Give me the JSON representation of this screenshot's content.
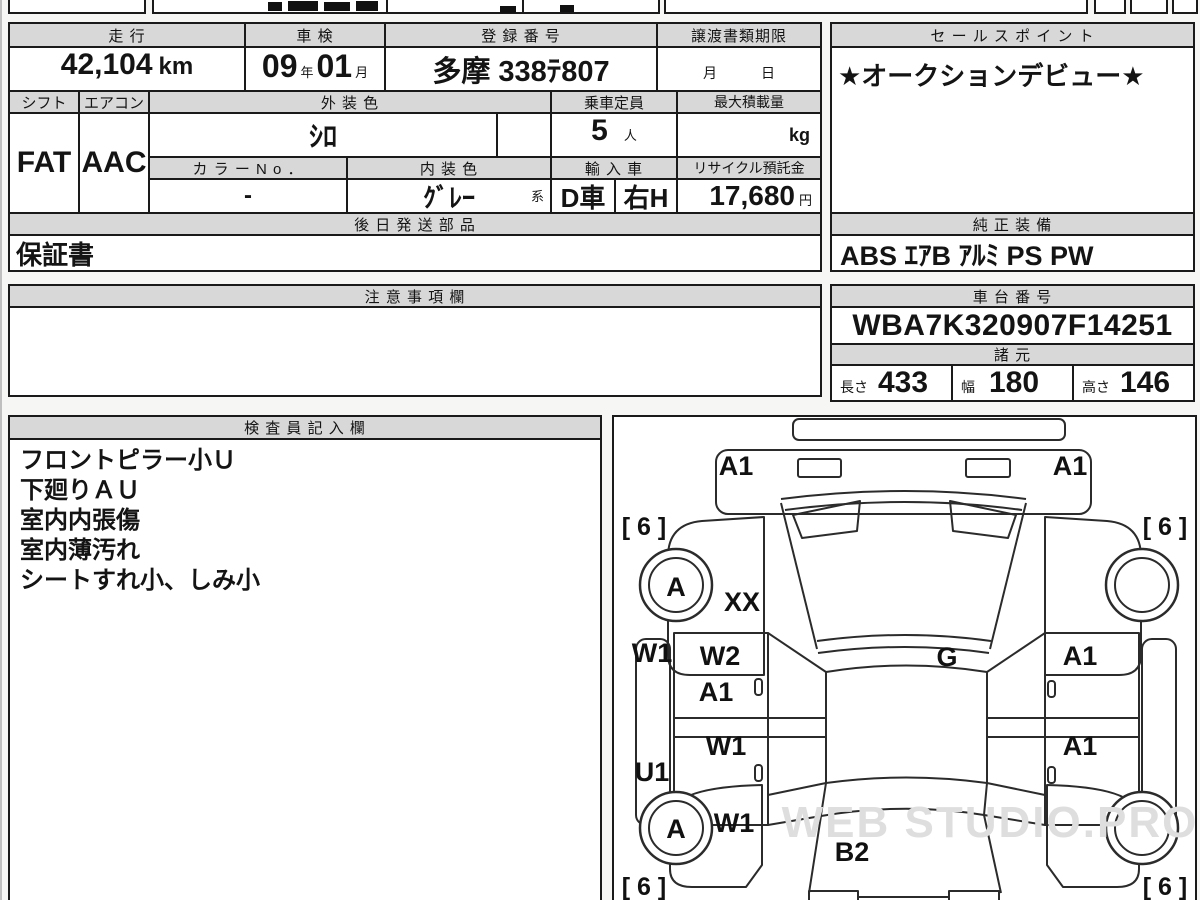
{
  "header_row": {
    "mileage_label": "走 行",
    "inspection_label": "車 検",
    "registration_label": "登 録 番 号",
    "transfer_label": "譲渡書類期限",
    "sales_point_label": "セ ー ル ス ポ イ ン ト"
  },
  "values": {
    "mileage": "42,104",
    "mileage_unit": "km",
    "inspection_year": "09",
    "year_suffix": "年",
    "inspection_month": "01",
    "month_suffix": "月",
    "registration": "多摩 338ﾃ807",
    "transfer_month": "月",
    "transfer_day": "日",
    "sales_point": "★オークションデビュー★"
  },
  "row2": {
    "shift_label": "シフト",
    "aircon_label": "エアコン",
    "exterior_label": "外 装 色",
    "capacity_label": "乗車定員",
    "max_load_label": "最大積載量",
    "shift": "FAT",
    "aircon": "AAC",
    "exterior_color": "ｼﾛ",
    "capacity": "5",
    "capacity_unit": "人",
    "max_load_unit": "kg",
    "color_no_label": "カ ラ ー N o ．",
    "interior_label": "内 装 色",
    "import_label": "輸 入 車",
    "recycle_label": "リサイクル預託金",
    "color_no": "-",
    "interior_color": "ｸﾞﾚｰ",
    "interior_suffix": "系",
    "import_type": "D車",
    "handle": "右H",
    "recycle_fee": "17,680",
    "recycle_unit": "円"
  },
  "later_parts": {
    "label": "後 日 発 送 部 品",
    "value": "保証書"
  },
  "equipment": {
    "label": "純 正 装 備",
    "value": "ABS ｴｱB ｱﾙﾐ PS PW"
  },
  "notes": {
    "label": "注 意 事 項 欄"
  },
  "chassis": {
    "label": "車 台 番 号",
    "value": "WBA7K320907F14251"
  },
  "specs": {
    "label": "諸 元",
    "items": [
      {
        "label": "長さ",
        "value": "433"
      },
      {
        "label": "幅",
        "value": "180"
      },
      {
        "label": "高さ",
        "value": "146"
      }
    ]
  },
  "inspector": {
    "label": "検 査 員 記 入 欄",
    "lines": [
      "フロントピラー小Ｕ",
      "下廻りＡＵ",
      "室内内張傷",
      "室内薄汚れ",
      "シートすれ小、しみ小"
    ]
  },
  "diagram": {
    "watermark": "WEB STUDIO.PRO",
    "labels": [
      {
        "text": "A1",
        "x": 122,
        "y": 58
      },
      {
        "text": "A1",
        "x": 456,
        "y": 58
      },
      {
        "text": "[ 6 ]",
        "x": 30,
        "y": 118,
        "small": true
      },
      {
        "text": "[ 6 ]",
        "x": 551,
        "y": 118,
        "small": true
      },
      {
        "text": "A",
        "x": 62,
        "y": 179
      },
      {
        "text": "XX",
        "x": 128,
        "y": 194
      },
      {
        "text": "W1",
        "x": 38,
        "y": 245
      },
      {
        "text": "W2",
        "x": 106,
        "y": 248
      },
      {
        "text": "A1",
        "x": 102,
        "y": 284
      },
      {
        "text": "G",
        "x": 333,
        "y": 249
      },
      {
        "text": "A1",
        "x": 466,
        "y": 248
      },
      {
        "text": "W1",
        "x": 112,
        "y": 338
      },
      {
        "text": "A1",
        "x": 466,
        "y": 338
      },
      {
        "text": "U1",
        "x": 38,
        "y": 364
      },
      {
        "text": "A",
        "x": 62,
        "y": 421
      },
      {
        "text": "W1",
        "x": 120,
        "y": 415
      },
      {
        "text": "B2",
        "x": 238,
        "y": 444
      },
      {
        "text": "[ 6 ]",
        "x": 30,
        "y": 478,
        "small": true
      },
      {
        "text": "[ 6 ]",
        "x": 551,
        "y": 478,
        "small": true
      }
    ]
  }
}
